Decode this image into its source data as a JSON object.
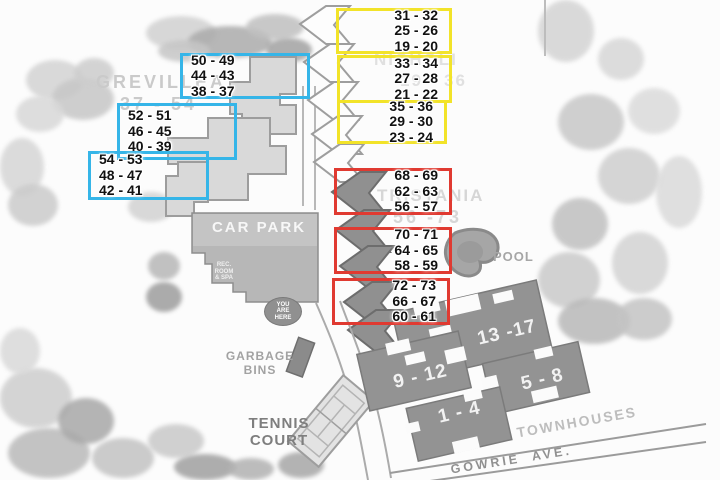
{
  "colors": {
    "cyan_box": "#35b5e8",
    "yellow_box": "#f2e329",
    "red_box": "#e03a31"
  },
  "buildings": {
    "grevillea": {
      "name": "GREVILLEA",
      "range": "37 - 54"
    },
    "nicholi": {
      "name": "NICHOLI",
      "range": "19 - 36"
    },
    "tristania": {
      "name": "TRISTANIA",
      "range": "56 -73"
    }
  },
  "boxes": {
    "y1": [
      "31 - 32",
      "25 - 26",
      "19 - 20"
    ],
    "y2": [
      "33 - 34",
      "27 - 28",
      "21 - 22"
    ],
    "y3": [
      "35 - 36",
      "29 - 30",
      "23 - 24"
    ],
    "c1": [
      "50 - 49",
      "44 - 43",
      "38 - 37"
    ],
    "c2": [
      "52 - 51",
      "46 - 45",
      "40 - 39"
    ],
    "c3": [
      "54 - 53",
      "48 - 47",
      "42 - 41"
    ],
    "r1": [
      "68 - 69",
      "62 - 63",
      "56 - 57"
    ],
    "r2": [
      "70 - 71",
      "64 - 65",
      "58 - 59"
    ],
    "r3": [
      "72 - 73",
      "66 - 67",
      "60 - 61"
    ]
  },
  "townhouses": {
    "label": "TOWNHOUSES",
    "b13_17": "13 -17",
    "b9_12": "9 - 12",
    "b5_8": "5 - 8",
    "b1_4": "1 - 4"
  },
  "labels": {
    "car_park": "CAR PARK",
    "rec_room_line1": "REC.",
    "rec_room_line2": "ROOM",
    "rec_room_line3": "& SPA",
    "you_are_here_line1": "YOU",
    "you_are_here_line2": "ARE",
    "you_are_here_line3": "HERE",
    "garbage_line1": "GARBAGE",
    "garbage_line2": "BINS",
    "tennis_line1": "TENNIS",
    "tennis_line2": "COURT",
    "pool": "POOL",
    "street": "GOWRIE AVE."
  }
}
